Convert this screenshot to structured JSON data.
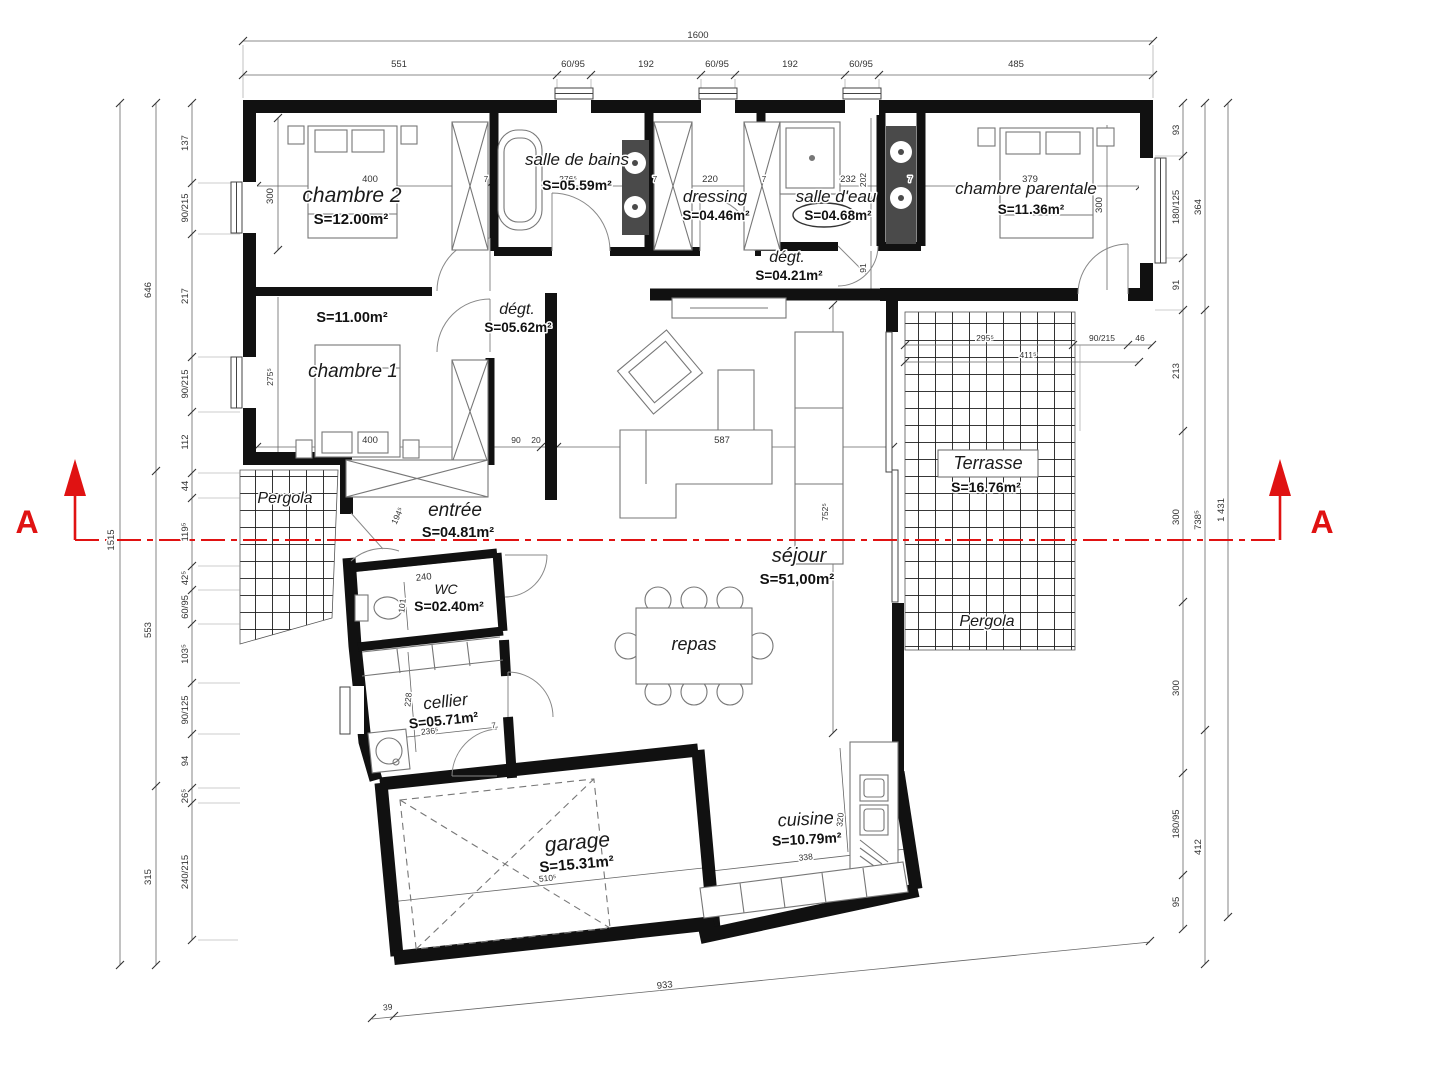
{
  "plan_title": "floor plan with section A-A",
  "colors": {
    "wall": "#111111",
    "line": "#555555",
    "dim_text": "#333333",
    "section_red": "#e01212",
    "fixture_dark": "#4a4a4a",
    "grid": "#1c1c1c"
  },
  "section_marker": {
    "left": "A",
    "right": "A"
  },
  "rooms": [
    {
      "name": "chambre 2",
      "area": "S=12.00m²"
    },
    {
      "name": "salle de bains",
      "area": "S=05.59m²"
    },
    {
      "name": "dressing",
      "area": "S=04.46m²"
    },
    {
      "name": "salle d'eau",
      "area": "S=04.68m²"
    },
    {
      "name": "chambre parentale",
      "area": "S=11.36m²"
    },
    {
      "name": "dégt.",
      "area": "S=04.21m²"
    },
    {
      "name": "dégt.",
      "area": "S=05.62m²"
    },
    {
      "name": "chambre 1",
      "area": "S=11.00m²"
    },
    {
      "name": "entrée",
      "area": "S=04.81m²"
    },
    {
      "name": "WC",
      "area": "S=02.40m²"
    },
    {
      "name": "cellier",
      "area": "S=05.71m²"
    },
    {
      "name": "garage",
      "area": "S=15.31m²"
    },
    {
      "name": "séjour",
      "area": "S=51,00m²"
    },
    {
      "name": "repas",
      "area": ""
    },
    {
      "name": "cuisine",
      "area": "S=10.79m²"
    },
    {
      "name": "Terrasse",
      "area": "S=16.76m²"
    },
    {
      "name": "Pergola",
      "area": ""
    },
    {
      "name": "Pergola",
      "area": ""
    }
  ],
  "annotations": [
    {
      "name": "dim-total-width",
      "text": "1600",
      "x": 698,
      "y": 38
    },
    {
      "name": "dim-top",
      "text": "551",
      "x": 399,
      "y": 67
    },
    {
      "name": "dim-top",
      "text": "60/95",
      "x": 573,
      "y": 67
    },
    {
      "name": "dim-top",
      "text": "192",
      "x": 646,
      "y": 67
    },
    {
      "name": "dim-top",
      "text": "60/95",
      "x": 717,
      "y": 67
    },
    {
      "name": "dim-top",
      "text": "192",
      "x": 790,
      "y": 67
    },
    {
      "name": "dim-top",
      "text": "60/95",
      "x": 861,
      "y": 67
    },
    {
      "name": "dim-top",
      "text": "485",
      "x": 1016,
      "y": 67
    },
    {
      "name": "dim-left-total",
      "text": "1515",
      "x": 114,
      "y": 540,
      "rot": -90
    },
    {
      "name": "dim-left",
      "text": "646",
      "x": 151,
      "y": 290,
      "rot": -90
    },
    {
      "name": "dim-left",
      "text": "553",
      "x": 151,
      "y": 630,
      "rot": -90
    },
    {
      "name": "dim-left",
      "text": "315",
      "x": 151,
      "y": 877,
      "rot": -90
    },
    {
      "name": "dim-left",
      "text": "137",
      "x": 188,
      "y": 143,
      "rot": -90
    },
    {
      "name": "dim-left",
      "text": "90/215",
      "x": 188,
      "y": 208,
      "rot": -90
    },
    {
      "name": "dim-left",
      "text": "217",
      "x": 188,
      "y": 296,
      "rot": -90
    },
    {
      "name": "dim-left",
      "text": "90/215",
      "x": 188,
      "y": 384,
      "rot": -90
    },
    {
      "name": "dim-left",
      "text": "112",
      "x": 188,
      "y": 442,
      "rot": -90
    },
    {
      "name": "dim-left",
      "text": "44",
      "x": 188,
      "y": 486,
      "rot": -90
    },
    {
      "name": "dim-left",
      "text": "119⁵",
      "x": 188,
      "y": 532,
      "rot": -90
    },
    {
      "name": "dim-left",
      "text": "42⁵",
      "x": 188,
      "y": 578,
      "rot": -90
    },
    {
      "name": "dim-left",
      "text": "60/95",
      "x": 188,
      "y": 607,
      "rot": -90
    },
    {
      "name": "dim-left",
      "text": "103⁵",
      "x": 188,
      "y": 654,
      "rot": -90
    },
    {
      "name": "dim-left",
      "text": "90/125",
      "x": 188,
      "y": 710,
      "rot": -90
    },
    {
      "name": "dim-left",
      "text": "94",
      "x": 188,
      "y": 761,
      "rot": -90
    },
    {
      "name": "dim-left",
      "text": "26⁵",
      "x": 188,
      "y": 796,
      "rot": -90
    },
    {
      "name": "dim-left",
      "text": "240/215",
      "x": 188,
      "y": 872,
      "rot": -90
    },
    {
      "name": "dim-right",
      "text": "93",
      "x": 1179,
      "y": 130,
      "rot": -90
    },
    {
      "name": "dim-right",
      "text": "180/125",
      "x": 1179,
      "y": 207,
      "rot": -90
    },
    {
      "name": "dim-right",
      "text": "91",
      "x": 1179,
      "y": 285,
      "rot": -90
    },
    {
      "name": "dim-right",
      "text": "213",
      "x": 1179,
      "y": 371,
      "rot": -90
    },
    {
      "name": "dim-right",
      "text": "300",
      "x": 1179,
      "y": 517,
      "rot": -90
    },
    {
      "name": "dim-right",
      "text": "300",
      "x": 1179,
      "y": 688,
      "rot": -90
    },
    {
      "name": "dim-right",
      "text": "180/95",
      "x": 1179,
      "y": 824,
      "rot": -90
    },
    {
      "name": "dim-right",
      "text": "95",
      "x": 1179,
      "y": 902,
      "rot": -90
    },
    {
      "name": "dim-right",
      "text": "364",
      "x": 1201,
      "y": 207,
      "rot": -90
    },
    {
      "name": "dim-right",
      "text": "738⁵",
      "x": 1201,
      "y": 520,
      "rot": -90
    },
    {
      "name": "dim-right",
      "text": "412",
      "x": 1201,
      "y": 847,
      "rot": -90
    },
    {
      "name": "dim-right-total",
      "text": "1 431",
      "x": 1224,
      "y": 510,
      "rot": -90
    },
    {
      "name": "dim-terrace",
      "text": "295⁵",
      "x": 985,
      "y": 341,
      "size": 8.5
    },
    {
      "name": "dim-terrace",
      "text": "90/215",
      "x": 1102,
      "y": 341,
      "size": 8.5
    },
    {
      "name": "dim-terrace",
      "text": "46",
      "x": 1140,
      "y": 341,
      "size": 8.5
    },
    {
      "name": "dim-terrace",
      "text": "411⁵",
      "x": 1028,
      "y": 358,
      "size": 8.5
    },
    {
      "name": "dim-room",
      "text": "400",
      "x": 370,
      "y": 182
    },
    {
      "name": "dim-room",
      "text": "300",
      "x": 273,
      "y": 196,
      "rot": -90
    },
    {
      "name": "dim-room",
      "text": "276⁵",
      "x": 568,
      "y": 182,
      "size": 8.5
    },
    {
      "name": "dim-wall",
      "text": "7",
      "x": 486,
      "y": 182,
      "size": 8
    },
    {
      "name": "dim-wall",
      "text": "7",
      "x": 655,
      "y": 182,
      "size": 8
    },
    {
      "name": "dim-room",
      "text": "220",
      "x": 710,
      "y": 182
    },
    {
      "name": "dim-wall",
      "text": "7",
      "x": 764,
      "y": 182,
      "size": 8
    },
    {
      "name": "dim-room",
      "text": "232",
      "x": 848,
      "y": 182
    },
    {
      "name": "dim-room",
      "text": "202",
      "x": 866,
      "y": 180,
      "rot": -90,
      "size": 8.5
    },
    {
      "name": "dim-wall",
      "text": "7",
      "x": 910,
      "y": 182,
      "size": 8
    },
    {
      "name": "dim-room",
      "text": "379",
      "x": 1030,
      "y": 182
    },
    {
      "name": "dim-room",
      "text": "300",
      "x": 1102,
      "y": 205,
      "rot": -90
    },
    {
      "name": "dim-room",
      "text": "91",
      "x": 866,
      "y": 268,
      "rot": -90,
      "size": 8.5
    },
    {
      "name": "dim-room",
      "text": "275⁵",
      "x": 273,
      "y": 377,
      "rot": -90,
      "size": 8.5
    },
    {
      "name": "dim-room",
      "text": "400",
      "x": 370,
      "y": 443
    },
    {
      "name": "dim-room",
      "text": "90",
      "x": 516,
      "y": 443,
      "size": 8.5
    },
    {
      "name": "dim-room",
      "text": "20",
      "x": 536,
      "y": 443,
      "size": 8.5
    },
    {
      "name": "dim-room",
      "text": "587",
      "x": 722,
      "y": 443
    },
    {
      "name": "dim-room",
      "text": "752⁵",
      "x": 828,
      "y": 512,
      "rot": -90,
      "size": 8.5
    },
    {
      "name": "dim-room",
      "text": "194⁵",
      "x": 400,
      "y": 517,
      "rot": -65,
      "size": 8.5
    },
    {
      "name": "dim-room",
      "text": "240",
      "x": 424,
      "y": 580,
      "rot": -6
    },
    {
      "name": "dim-room",
      "text": "101",
      "x": 405,
      "y": 606,
      "rot": -84,
      "size": 8.5
    },
    {
      "name": "dim-room",
      "text": "228",
      "x": 411,
      "y": 700,
      "rot": -84,
      "size": 8.5
    },
    {
      "name": "dim-room",
      "text": "236⁵",
      "x": 430,
      "y": 734,
      "rot": -6,
      "size": 8.5
    },
    {
      "name": "dim-wall",
      "text": "7",
      "x": 494,
      "y": 728,
      "rot": -6,
      "size": 8
    },
    {
      "name": "dim-room",
      "text": "510⁵",
      "x": 548,
      "y": 881,
      "rot": -6,
      "size": 8.5
    },
    {
      "name": "dim-room",
      "text": "320",
      "x": 843,
      "y": 820,
      "rot": -84,
      "size": 8.5
    },
    {
      "name": "dim-room",
      "text": "338",
      "x": 806,
      "y": 860,
      "rot": -6,
      "size": 8.5
    },
    {
      "name": "dim-bottom",
      "text": "39",
      "x": 388,
      "y": 1010,
      "rot": -6,
      "size": 8.5
    },
    {
      "name": "dim-bottom",
      "text": "933",
      "x": 665,
      "y": 988,
      "rot": -6
    },
    {
      "name": "room-label-chambre-2",
      "text": "chambre 2",
      "x": 352,
      "y": 202,
      "cls": "room",
      "size": 21
    },
    {
      "name": "room-area-chambre-2",
      "text": "S=12.00m²",
      "x": 351,
      "y": 224,
      "cls": "area",
      "size": 15
    },
    {
      "name": "room-label-salle-de-bains",
      "text": "salle de bains",
      "x": 577,
      "y": 165,
      "cls": "room",
      "size": 17
    },
    {
      "name": "room-area-salle-de-bains",
      "text": "S=05.59m²",
      "x": 577,
      "y": 190,
      "cls": "area",
      "size": 14
    },
    {
      "name": "room-label-dressing",
      "text": "dressing",
      "x": 715,
      "y": 202,
      "cls": "room",
      "size": 17
    },
    {
      "name": "room-area-dressing",
      "text": "S=04.46m²",
      "x": 716,
      "y": 220,
      "cls": "area",
      "size": 13.5
    },
    {
      "name": "room-label-salle-d-eau",
      "text": "salle d'eau",
      "x": 836,
      "y": 202,
      "cls": "room",
      "size": 17
    },
    {
      "name": "room-area-salle-d-eau",
      "text": "S=04.68m²",
      "x": 838,
      "y": 220,
      "cls": "area",
      "size": 13.5
    },
    {
      "name": "room-label-chambre-parentale",
      "text": "chambre parentale",
      "x": 1026,
      "y": 194,
      "cls": "room",
      "size": 17
    },
    {
      "name": "room-area-chambre-parentale",
      "text": "S=11.36m²",
      "x": 1031,
      "y": 214,
      "cls": "area",
      "size": 13.5
    },
    {
      "name": "room-label-degt-1",
      "text": "dégt.",
      "x": 787,
      "y": 262,
      "cls": "room",
      "size": 16
    },
    {
      "name": "room-area-degt-1",
      "text": "S=04.21m²",
      "x": 789,
      "y": 280,
      "cls": "area",
      "size": 13.5
    },
    {
      "name": "room-label-degt-2",
      "text": "dégt.",
      "x": 517,
      "y": 314,
      "cls": "room",
      "size": 16
    },
    {
      "name": "room-area-degt-2",
      "text": "S=05.62m²",
      "x": 518,
      "y": 332,
      "cls": "area",
      "size": 13.5
    },
    {
      "name": "room-area-chambre-1",
      "text": "S=11.00m²",
      "x": 352,
      "y": 322,
      "cls": "area",
      "size": 14.5
    },
    {
      "name": "room-label-chambre-1",
      "text": "chambre 1",
      "x": 353,
      "y": 377,
      "cls": "room",
      "size": 19
    },
    {
      "name": "room-label-entree",
      "text": "entrée",
      "x": 455,
      "y": 516,
      "cls": "room",
      "size": 19
    },
    {
      "name": "room-area-entree",
      "text": "S=04.81m²",
      "x": 458,
      "y": 537,
      "cls": "area",
      "size": 14.5
    },
    {
      "name": "room-label-pergola-left",
      "text": "Pergola",
      "x": 285,
      "y": 503,
      "cls": "room",
      "size": 16
    },
    {
      "name": "room-label-wc",
      "text": "WC",
      "x": 446,
      "y": 594,
      "cls": "room",
      "size": 14
    },
    {
      "name": "room-area-wc",
      "text": "S=02.40m²",
      "x": 449,
      "y": 611,
      "cls": "area",
      "size": 14
    },
    {
      "name": "room-label-cellier",
      "text": "cellier",
      "x": 446,
      "y": 707,
      "cls": "room",
      "size": 17,
      "rot": -6
    },
    {
      "name": "room-area-cellier",
      "text": "S=05.71m²",
      "x": 444,
      "y": 725,
      "cls": "area",
      "size": 14,
      "rot": -6
    },
    {
      "name": "room-label-garage",
      "text": "garage",
      "x": 578,
      "y": 849,
      "cls": "room",
      "size": 21,
      "rot": -5
    },
    {
      "name": "room-area-garage",
      "text": "S=15.31m²",
      "x": 577,
      "y": 869,
      "cls": "area",
      "size": 15,
      "rot": -5
    },
    {
      "name": "room-label-sejour",
      "text": "séjour",
      "x": 799,
      "y": 562,
      "cls": "room",
      "size": 20
    },
    {
      "name": "room-area-sejour",
      "text": "S=51,00m²",
      "x": 797,
      "y": 584,
      "cls": "area",
      "size": 15
    },
    {
      "name": "room-label-repas",
      "text": "repas",
      "x": 694,
      "y": 650,
      "cls": "room",
      "size": 18
    },
    {
      "name": "room-label-cuisine",
      "text": "cuisine",
      "x": 806,
      "y": 825,
      "cls": "room",
      "size": 18,
      "rot": -3
    },
    {
      "name": "room-area-cuisine",
      "text": "S=10.79m²",
      "x": 807,
      "y": 844,
      "cls": "area",
      "size": 14,
      "rot": -3
    },
    {
      "name": "room-label-terrasse",
      "text": "Terrasse",
      "x": 988,
      "y": 469,
      "cls": "room",
      "size": 18
    },
    {
      "name": "room-area-terrasse",
      "text": "S=16.76m²",
      "x": 986,
      "y": 492,
      "cls": "area",
      "size": 14
    },
    {
      "name": "room-label-pergola-right",
      "text": "Pergola",
      "x": 987,
      "y": 626,
      "cls": "room",
      "size": 16
    },
    {
      "name": "section-label-a-left",
      "text": "A",
      "x": 27,
      "y": 533,
      "cls": "section",
      "size": 32
    },
    {
      "name": "section-label-a-right",
      "text": "A",
      "x": 1322,
      "y": 533,
      "cls": "section",
      "size": 32
    }
  ]
}
